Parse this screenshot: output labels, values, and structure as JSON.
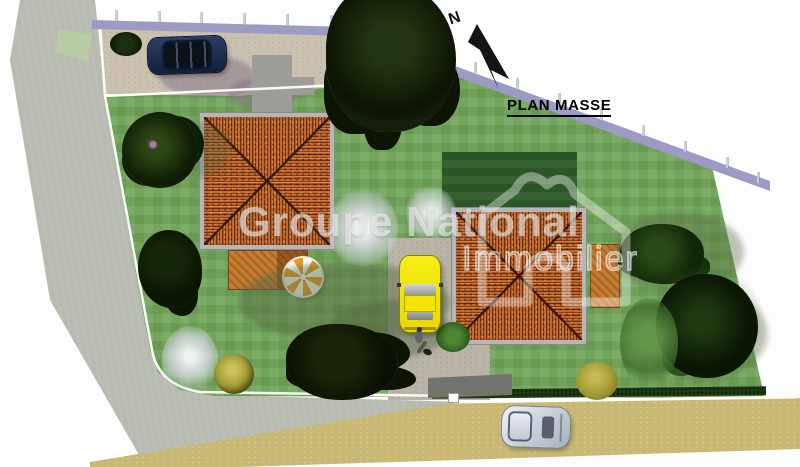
{
  "plan": {
    "title": "PLAN MASSE",
    "compass": {
      "label": "N",
      "direction": "north-upper-left"
    },
    "watermark": {
      "line1": "Groupe National",
      "line2": "Immobilier",
      "logo": "house-outline"
    }
  },
  "palette": {
    "lawn_green": "#70a558",
    "dark_garden_square": "#2f5b2b",
    "road_gray": "#b7bab0",
    "road_tan": "#c8b873",
    "driveway_beige": "#cac1b1",
    "boundary_wall_lavender": "#9b9bc4",
    "roof_tile_orange": "#a8541e",
    "house_border_gray": "#b6b6b6",
    "wood_deck": "#c57c30",
    "parasol_orange": "#f09a1e",
    "hedge_dark_green": "#1e3a13",
    "car_navy": "#1b2b4d",
    "car_yellow": "#f2e600",
    "car_silver": "#ccd2dc"
  },
  "inventory": {
    "buildings": [
      "house-west-hip-roof",
      "house-east-hip-roof"
    ],
    "vehicles": [
      "navy-car-north-parking",
      "yellow-car-east-driveway",
      "silver-car-south-road"
    ],
    "features": [
      "north-arrow",
      "perimeter-fence-posts",
      "lavender-boundary-wall",
      "white-property-lines",
      "south-hedge",
      "wood-deck-west",
      "wood-deck-east",
      "parasol",
      "pedestrian",
      "trees-and-shrubs",
      "road-marking"
    ]
  }
}
